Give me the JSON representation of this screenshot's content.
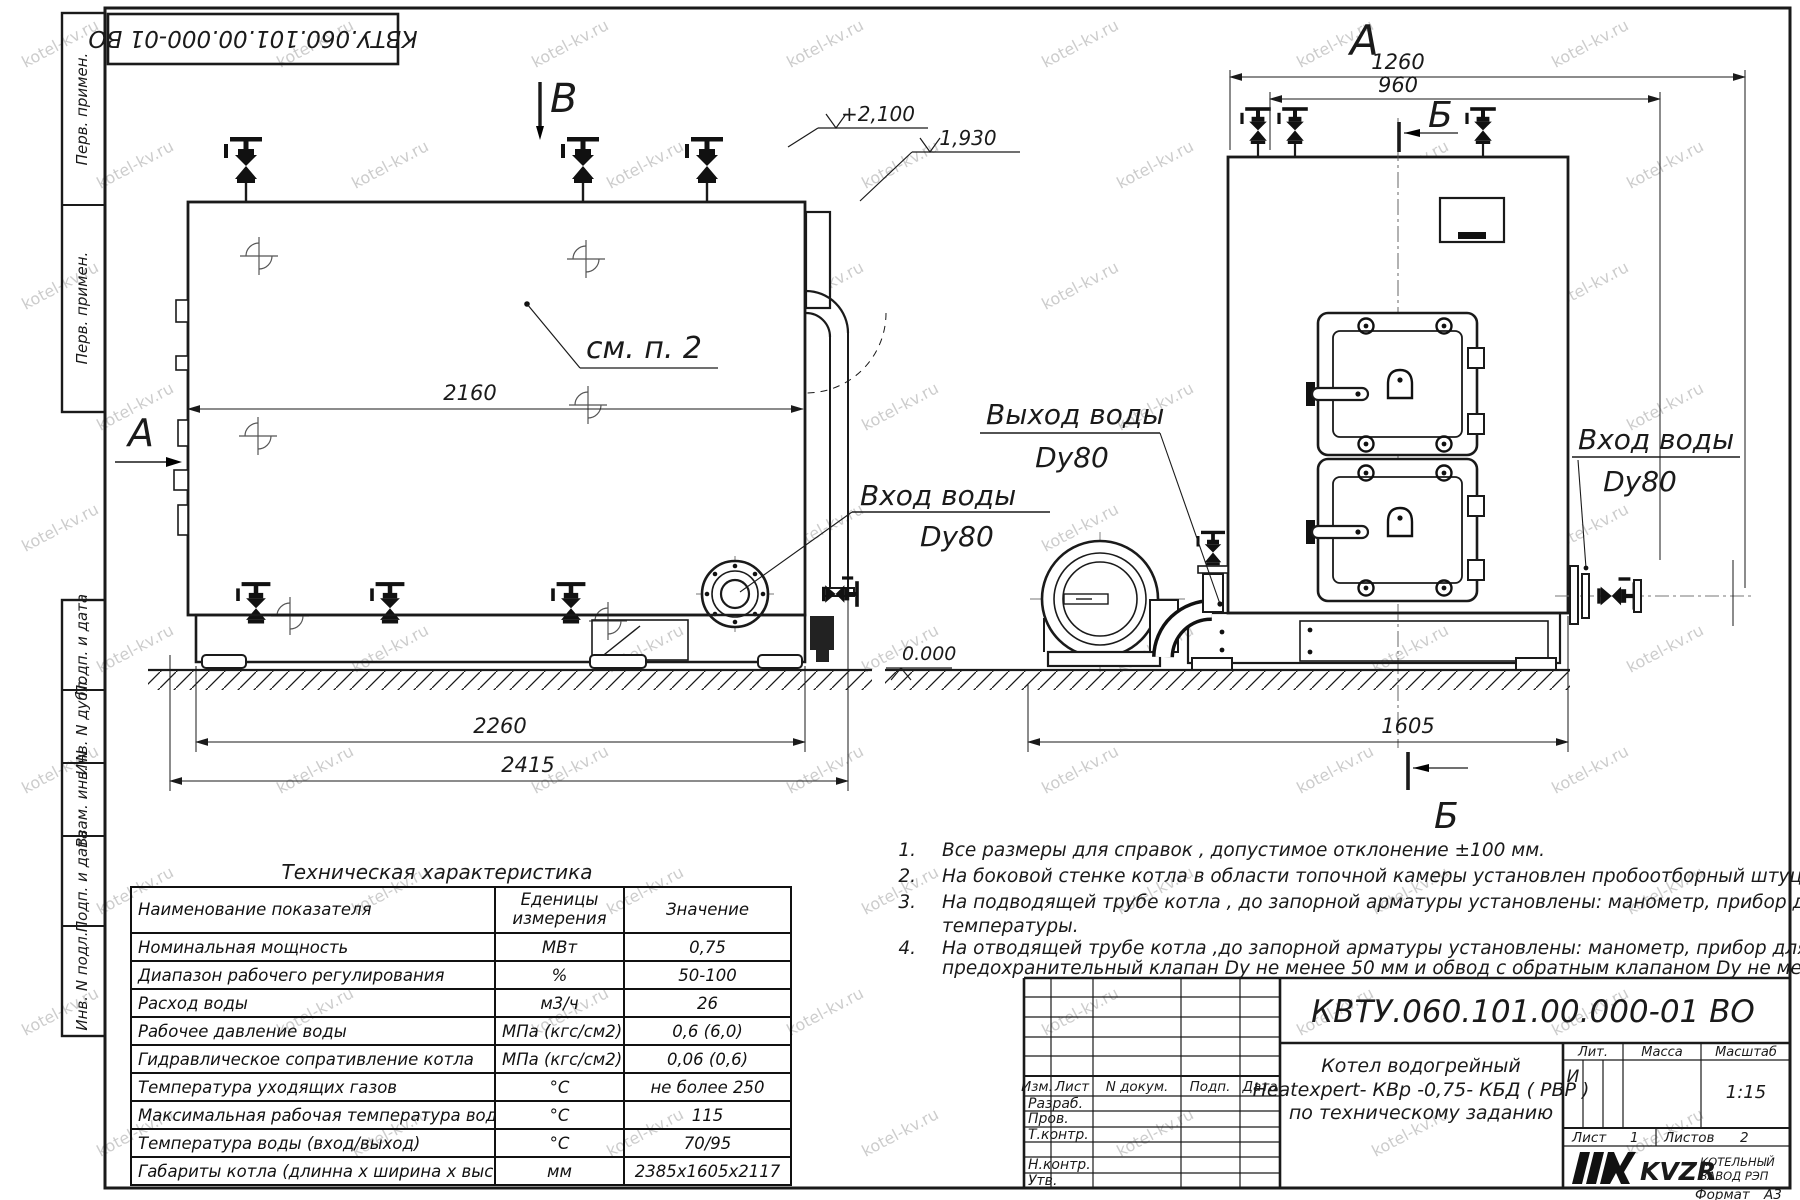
{
  "meta": {
    "colors": {
      "ink": "#1a1a1a",
      "watermark": "#9b9b9b",
      "paper": "#ffffff"
    },
    "watermark_text": "kotel-kv.ru"
  },
  "stamp": {
    "code": "КВТУ.060.101.00.000-01 ВО"
  },
  "margin_labels": [
    "Перв. примен.",
    "Перв. примен.",
    "Подп. и дата",
    "Инв. N дубл.",
    "Взам. инв. N",
    "Подп. и дата",
    "Инв. N подл."
  ],
  "drawing": {
    "section_b": "B",
    "view_a_label": "А",
    "front_label": "А",
    "section_b2_top": "Б",
    "section_b2_bottom": "Б",
    "elev_2100": "+2,100",
    "elev_1930": "1,930",
    "elev_0": "0.000",
    "see_note": "см. п. 2",
    "dims": {
      "d2160": "2160",
      "d2260": "2260",
      "d2415": "2415",
      "d1260": "1260",
      "d960": "960",
      "d1605": "1605"
    },
    "labels": {
      "inlet_side": [
        "Вход воды",
        "Dy80"
      ],
      "outlet_front": [
        "Выход воды",
        "Dy80"
      ],
      "inlet_front": [
        "Вход воды",
        "Dy80"
      ]
    }
  },
  "notes": {
    "items": [
      {
        "num": "1.",
        "lines": [
          "Все размеры для справок , допустимое отклонение  ±100 мм."
        ]
      },
      {
        "num": "2.",
        "lines": [
          "На боковой стенке котла в области топочной камеры установлен пробоотборный штуцер"
        ]
      },
      {
        "num": "3.",
        "lines": [
          "На  подводящей трубе котла , до запорной арматуры установлены: манометр, прибор для измерения",
          "температуры."
        ]
      },
      {
        "num": "4.",
        "lines": [
          "На отводящей трубе котла ,до запорной арматуры установлены: манометр, прибор для измерения температуры,",
          "предохранительный клапан  Dу не менее  50 мм и обвод с обратным клапаном  Dу не менее  50 мм."
        ]
      }
    ]
  },
  "tech_table": {
    "title": "Техническая характеристика",
    "headers": [
      "Наименование показателя",
      "Еденицы измерения",
      "Значение"
    ],
    "rows": [
      [
        "Номинальная мощность",
        "МВт",
        "0,75"
      ],
      [
        "Диапазон рабочего регулирования",
        "%",
        "50-100"
      ],
      [
        "Расход воды",
        "м3/ч",
        "26"
      ],
      [
        "Рабочее давление воды",
        "МПа (кгс/см2)",
        "0,6 (6,0)"
      ],
      [
        "Гидравлическое сопративление котла",
        "МПа (кгс/см2)",
        "0,06 (0,6)"
      ],
      [
        "Температура уходящих газов",
        "°С",
        "не более 250"
      ],
      [
        "Максимальная рабочая температура воды",
        "°С",
        "115"
      ],
      [
        "Температура воды (вход/выход)",
        "°С",
        "70/95"
      ],
      [
        "Габариты котла (длинна х ширина х высота)",
        "мм",
        "2385х1605х2117"
      ]
    ]
  },
  "title_block": {
    "doc_number": "КВТУ.060.101.00.000-01 ВО",
    "columns": [
      "Изм.",
      "Лист",
      "N докум.",
      "Подп.",
      "Дата"
    ],
    "roles": [
      "Разраб.",
      "Пров.",
      "Т.контр.",
      "Н.контр.",
      "Утв."
    ],
    "name_lines": [
      "Котел водогрейный",
      "Heatexpert- КВр -0,75- КБД ( РВР )",
      "по техническому заданию"
    ],
    "lit_label": "Лит.",
    "lit_value": "И",
    "mass_label": "Масса",
    "scale_label": "Масштаб",
    "scale_value": "1:15",
    "sheet_label": "Лист",
    "sheet_value": "1",
    "sheets_label": "Листов",
    "sheets_value": "2",
    "brand": "KVZR",
    "company_lines": [
      "КОТЕЛЬНЫЙ",
      "ЗАВОД РЭП"
    ],
    "format_label": "Формат",
    "format_value": "А3"
  }
}
